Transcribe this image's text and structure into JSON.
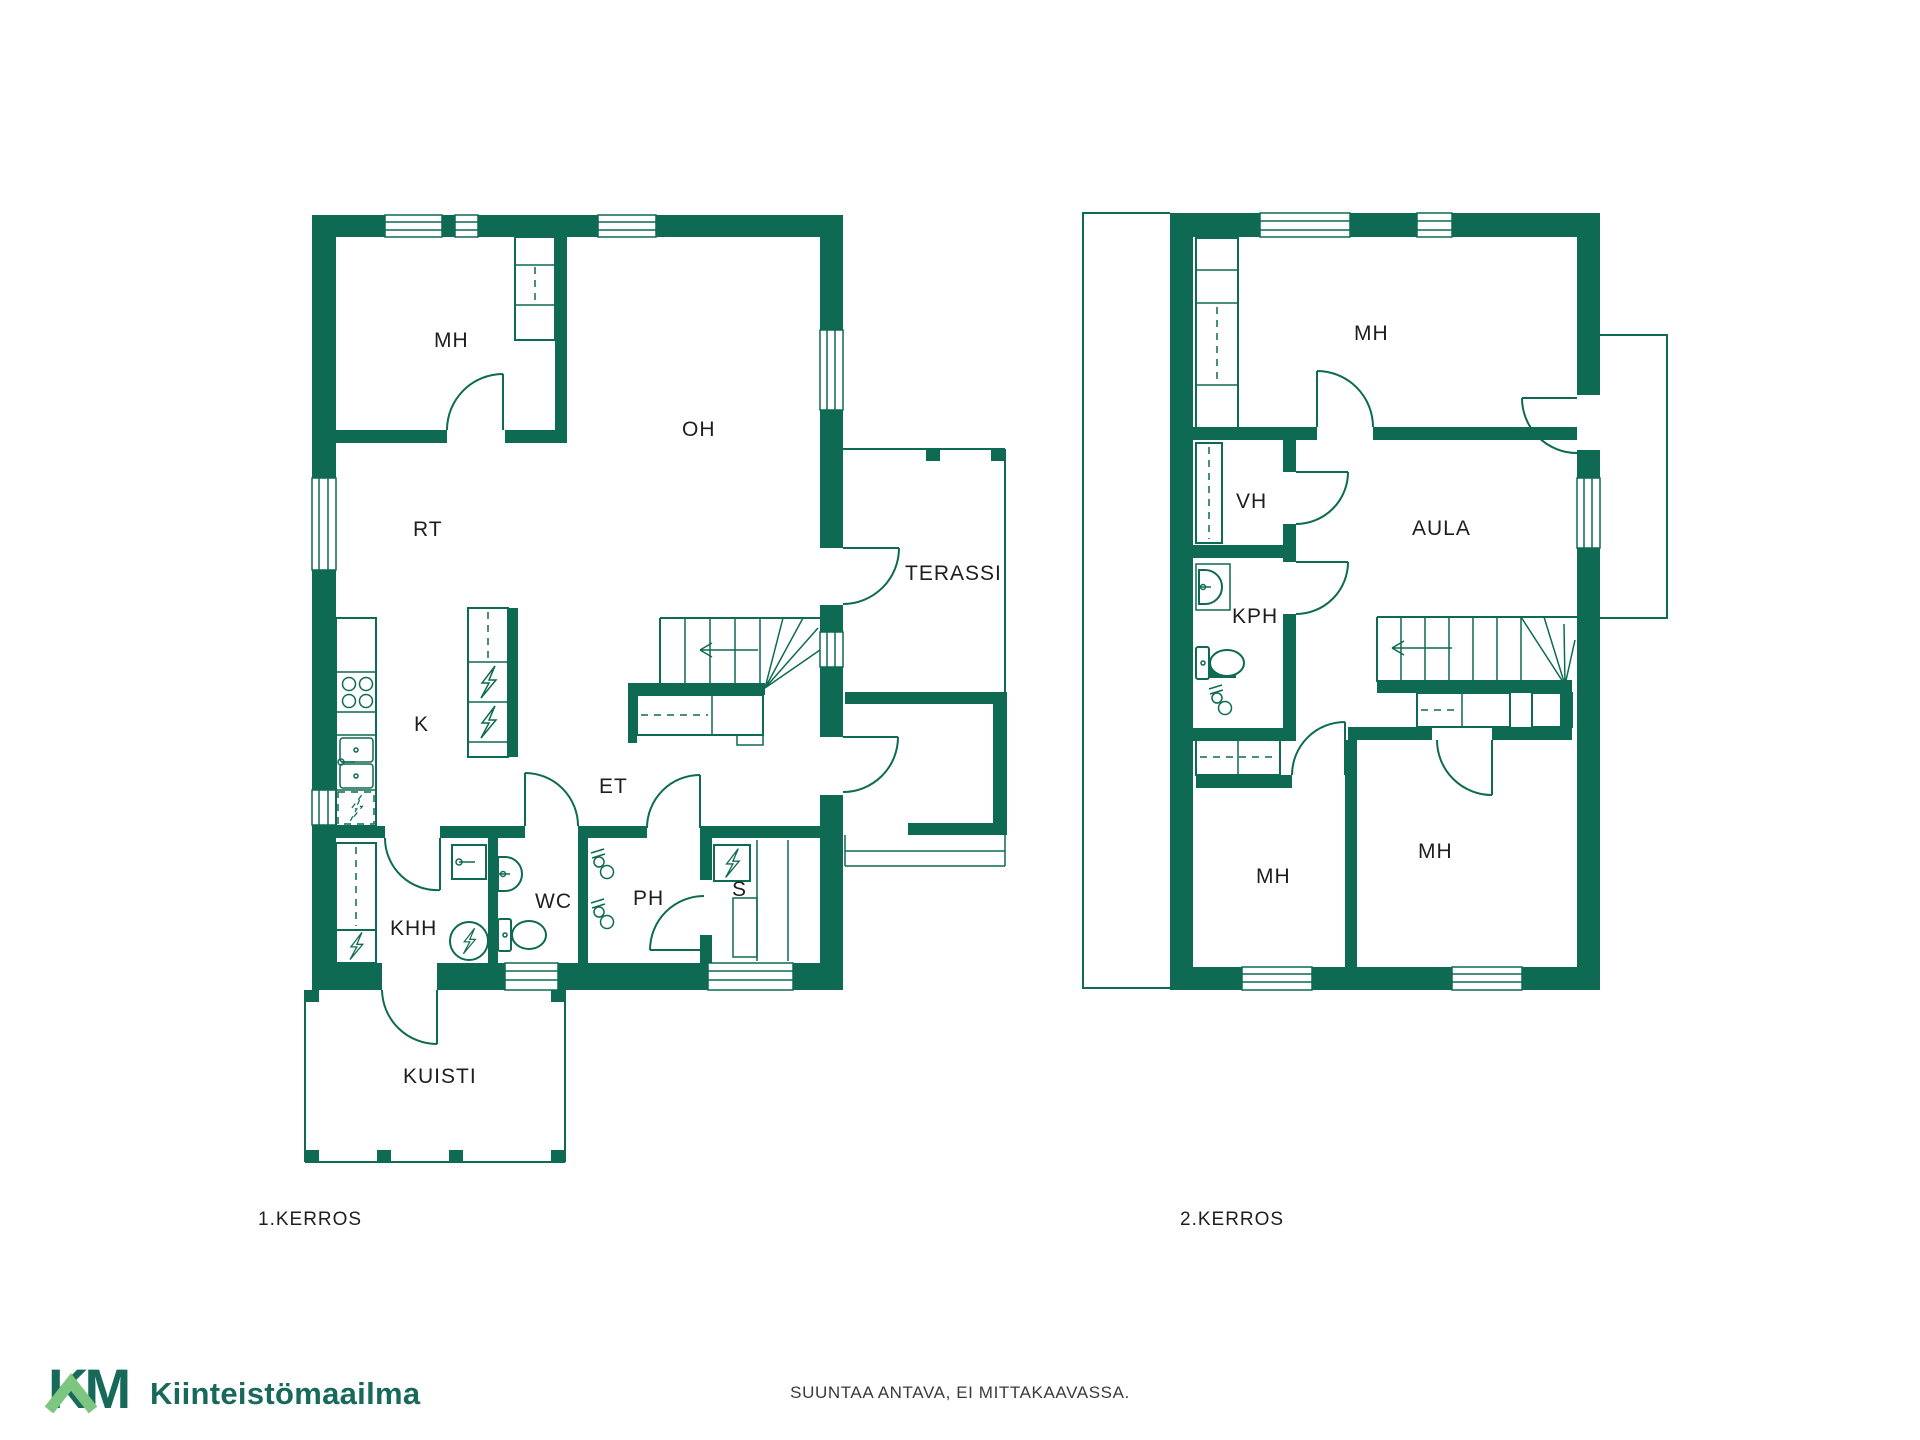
{
  "colors": {
    "wall": "#0E6A52",
    "logo_dark": "#17695A",
    "logo_light": "#7CC67F",
    "label_text": "#1E1E1E",
    "footer_text": "#3A3A3A"
  },
  "floor1": {
    "caption": "1.KERROS",
    "rooms": [
      {
        "label": "MH"
      },
      {
        "label": "OH"
      },
      {
        "label": "RT"
      },
      {
        "label": "K"
      },
      {
        "label": "ET"
      },
      {
        "label": "KHH"
      },
      {
        "label": "WC"
      },
      {
        "label": "PH"
      },
      {
        "label": "S"
      },
      {
        "label": "TERASSI"
      },
      {
        "label": "KUISTI"
      }
    ]
  },
  "floor2": {
    "caption": "2.KERROS",
    "rooms": [
      {
        "label": "MH"
      },
      {
        "label": "VH"
      },
      {
        "label": "AULA"
      },
      {
        "label": "KPH"
      },
      {
        "label": "MH"
      },
      {
        "label": "MH"
      }
    ]
  },
  "footer": {
    "disclaimer": "SUUNTAA ANTAVA, EI MITTAKAAVASSA."
  },
  "brand": {
    "mark": "KM",
    "name": "Kiinteistömaailma"
  },
  "icons": [
    "stove-icon",
    "sink-icon",
    "dishwasher-icon",
    "fridge-freezer-icon",
    "washing-machine-icon",
    "water-heater-icon",
    "toilet-icon",
    "washbasin-icon",
    "shower-mixer-icon",
    "sauna-stove-icon",
    "stairs-icon",
    "door-arc-icon",
    "window-icon",
    "wardrobe-icon"
  ]
}
